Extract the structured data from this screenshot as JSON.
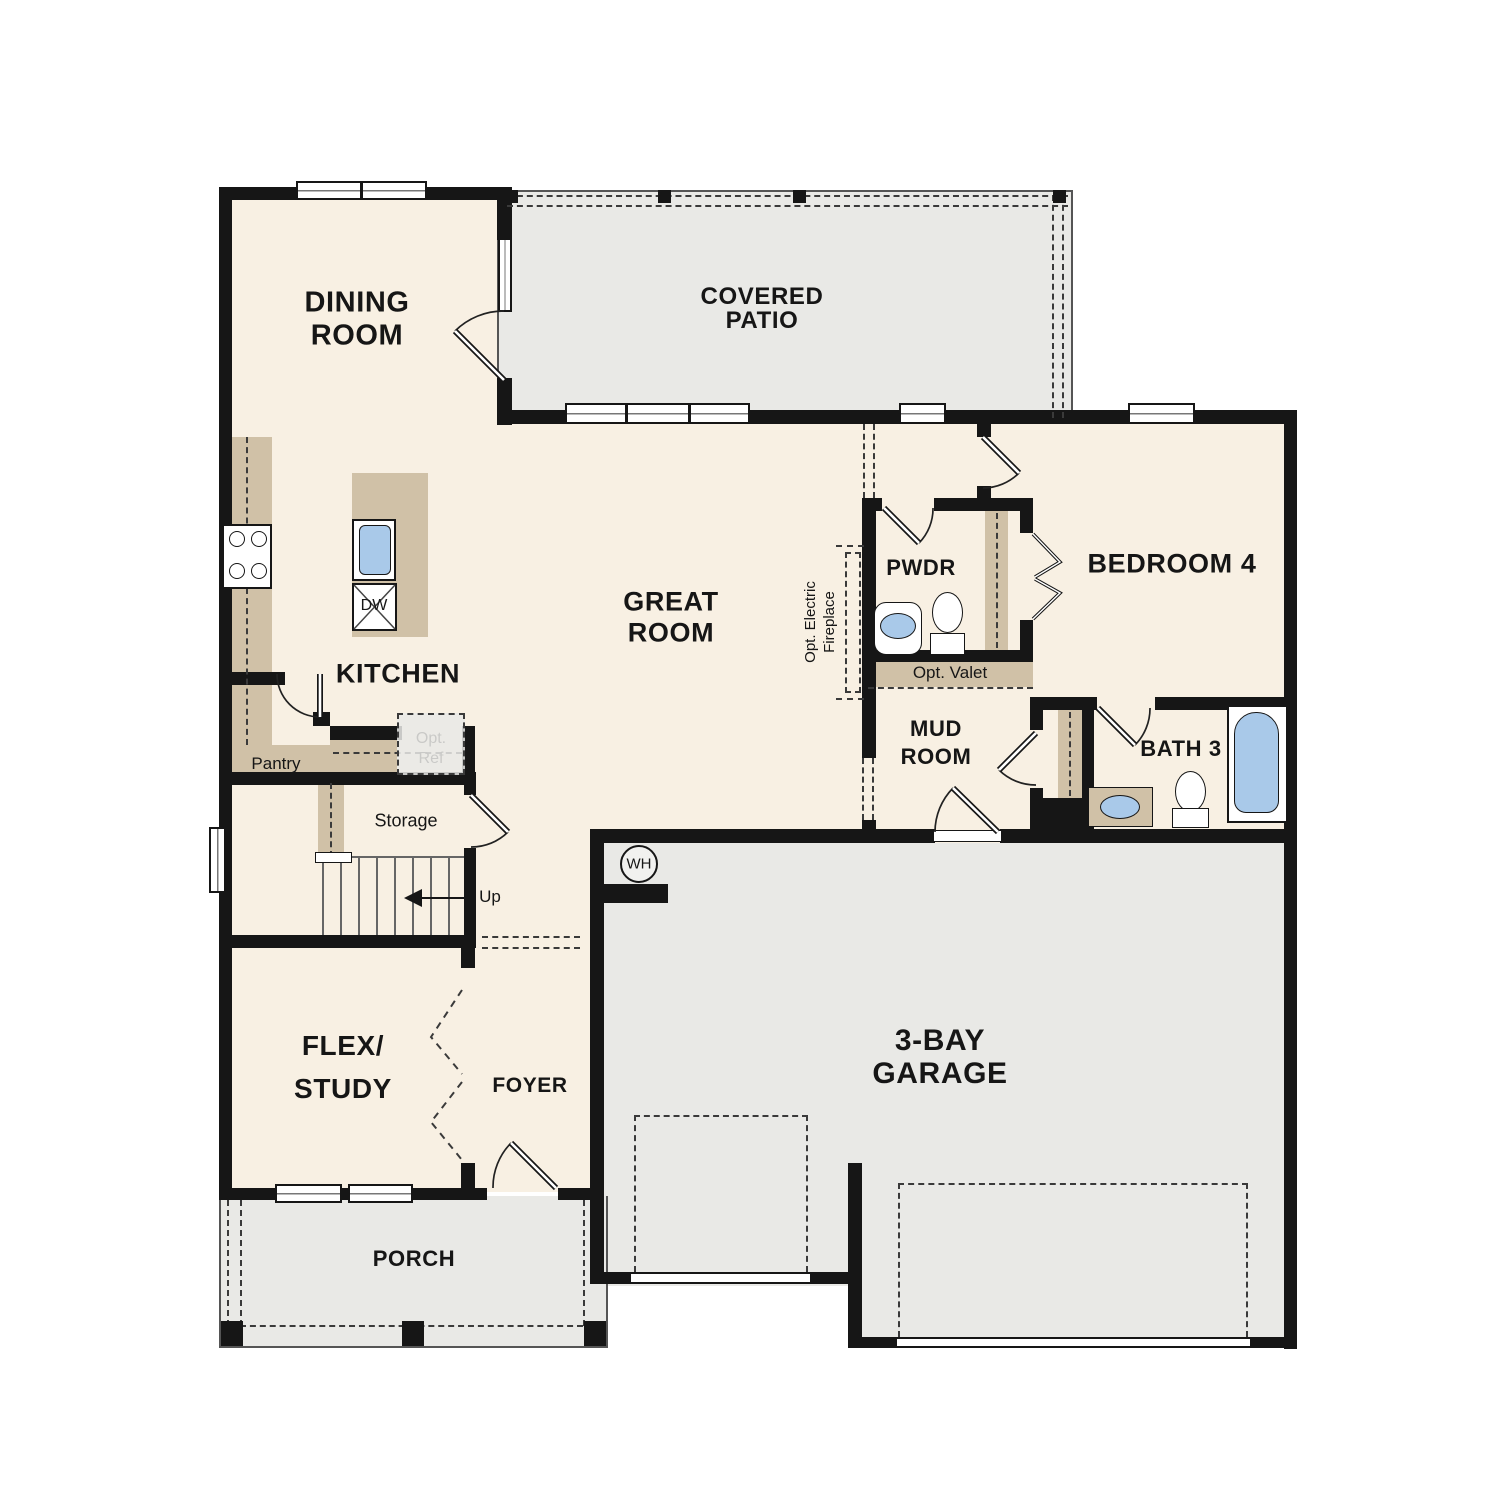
{
  "floorplan": {
    "rooms": {
      "dining": {
        "line1": "DINING",
        "line2": "ROOM"
      },
      "covered_patio": {
        "line1": "COVERED",
        "line2": "PATIO"
      },
      "great_room": {
        "line1": "GREAT",
        "line2": "ROOM"
      },
      "kitchen": {
        "label": "KITCHEN"
      },
      "pwdr": {
        "label": "PWDR"
      },
      "bedroom4": {
        "label": "BEDROOM 4"
      },
      "mud_room": {
        "line1": "MUD",
        "line2": "ROOM"
      },
      "bath3": {
        "label": "BATH 3"
      },
      "flex_study": {
        "line1": "FLEX/",
        "line2": "STUDY"
      },
      "foyer": {
        "label": "FOYER"
      },
      "garage": {
        "line1": "3-BAY",
        "line2": "GARAGE"
      },
      "porch": {
        "label": "PORCH"
      }
    },
    "features": {
      "pantry": "Pantry",
      "storage": "Storage",
      "stairs_up": "Up",
      "opt_ref_line1": "Opt.",
      "opt_ref_line2": "Ref",
      "opt_valet": "Opt. Valet",
      "opt_fireplace_line1": "Opt. Electric",
      "opt_fireplace_line2": "Fireplace",
      "dishwasher": "DW",
      "water_heater": "WH"
    },
    "colors": {
      "floor-cream": "#f8f0e3",
      "slab-gray": "#e9e9e6",
      "cabinet-tan": "#d0c1a7",
      "fixture-blue": "#a9c9e9",
      "wall-black": "#161616",
      "line-dark": "#3a3a3a"
    }
  }
}
